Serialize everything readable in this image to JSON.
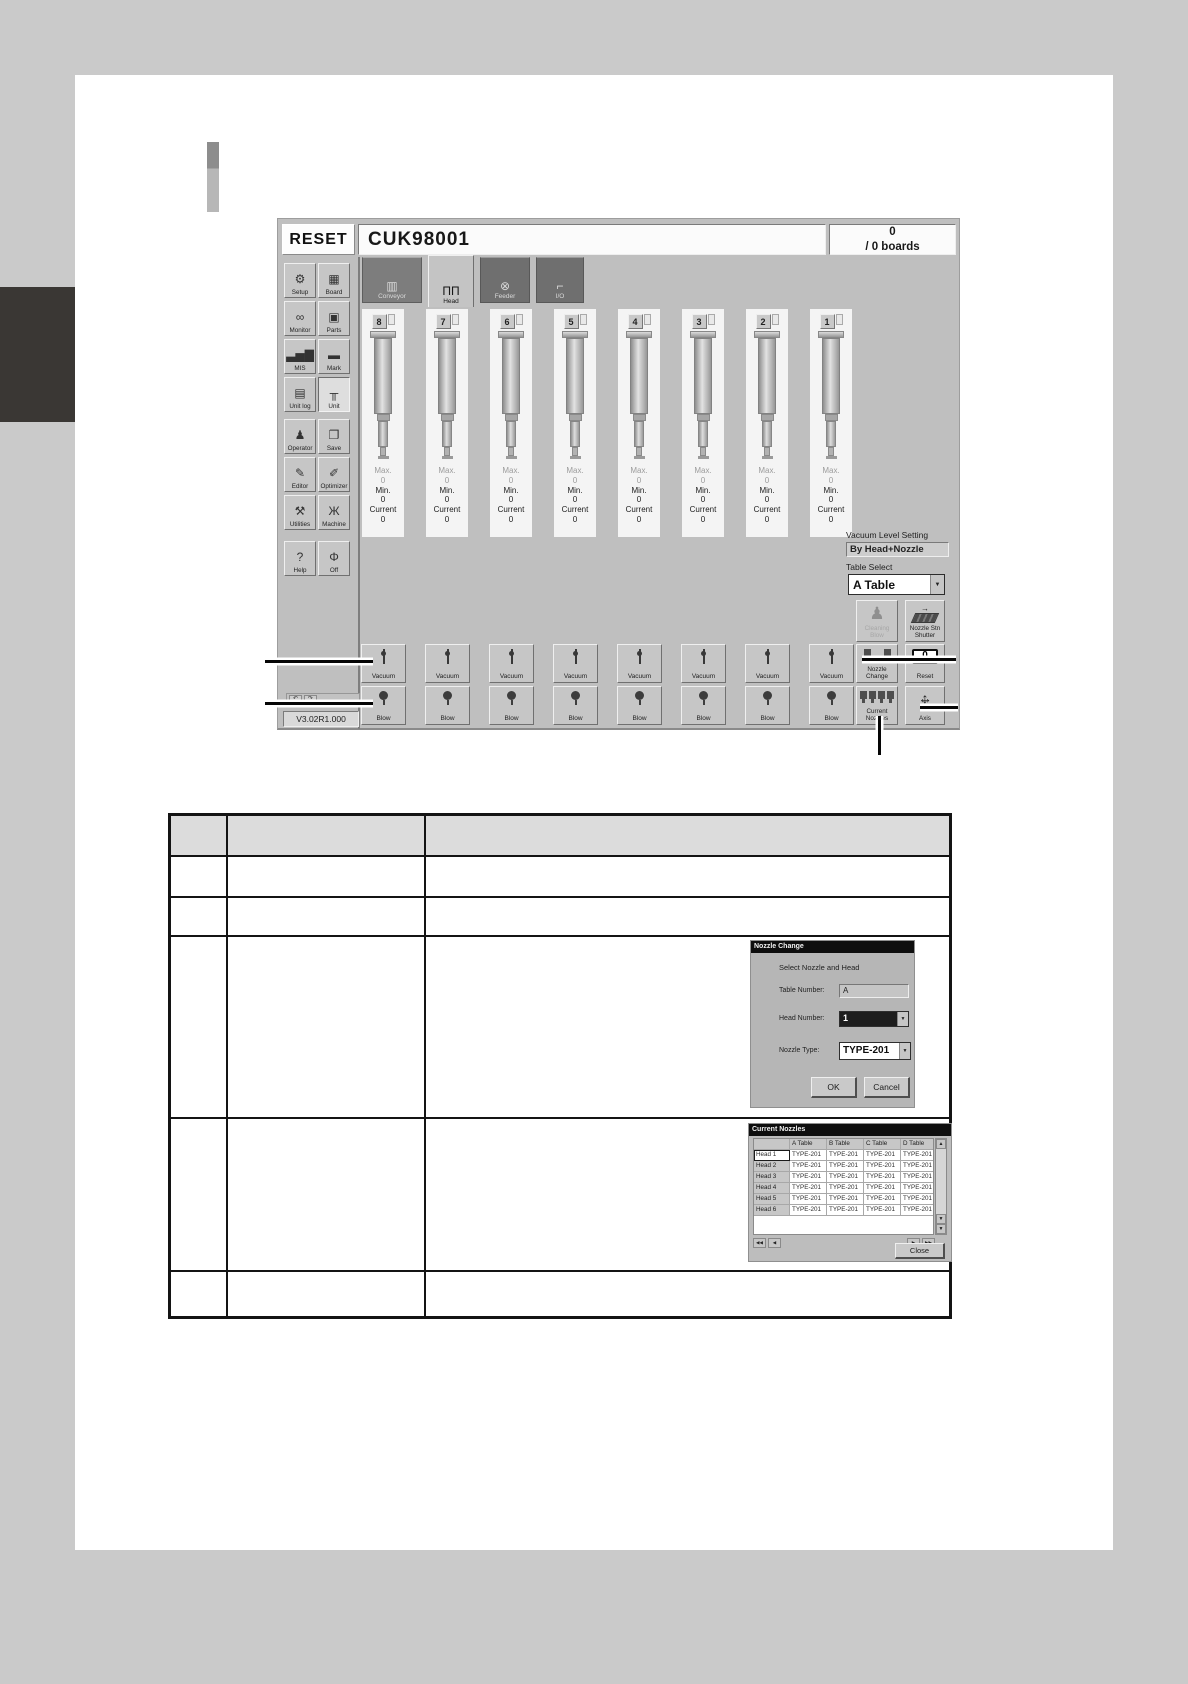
{
  "machine_ui": {
    "reset_button": "RESET",
    "title": "CUK98001",
    "boards": {
      "count": "0",
      "label": "/ 0 boards"
    },
    "sidebar": {
      "buttons": [
        {
          "label": "Setup",
          "icon": "setup-icon",
          "glyph": "⚙"
        },
        {
          "label": "Board",
          "icon": "board-icon",
          "glyph": "▦"
        },
        {
          "label": "Monitor",
          "icon": "monitor-icon",
          "glyph": "∞"
        },
        {
          "label": "Parts",
          "icon": "parts-icon",
          "glyph": "▣"
        },
        {
          "label": "MIS",
          "icon": "mis-icon",
          "glyph": "▃▅▇"
        },
        {
          "label": "Mark",
          "icon": "mark-icon",
          "glyph": "▬"
        },
        {
          "label": "Unit log",
          "icon": "unit-log-icon",
          "glyph": "▤"
        },
        {
          "label": "Unit",
          "icon": "unit-icon",
          "glyph": "╥",
          "active": true
        },
        {
          "label": "Operator",
          "icon": "operator-icon",
          "glyph": "♟"
        },
        {
          "label": "Save",
          "icon": "save-icon",
          "glyph": "❐"
        },
        {
          "label": "Editor",
          "icon": "editor-icon",
          "glyph": "✎"
        },
        {
          "label": "Optimizer",
          "icon": "optimizer-icon",
          "glyph": "✐"
        },
        {
          "label": "Utilities",
          "icon": "utilities-icon",
          "glyph": "⚒"
        },
        {
          "label": "Machine",
          "icon": "machine-icon",
          "glyph": "Ж"
        },
        {
          "label": "Help",
          "icon": "help-icon",
          "glyph": "?"
        },
        {
          "label": "Off",
          "icon": "off-icon",
          "glyph": "Φ"
        }
      ]
    },
    "tabs": [
      {
        "label": "Conveyor",
        "icon": "conveyor-icon",
        "glyph": "▥",
        "state": "pressed"
      },
      {
        "label": "Head",
        "icon": "head-icon",
        "glyph": "ΠΠ",
        "state": "active"
      },
      {
        "label": "Feeder",
        "icon": "feeder-icon",
        "glyph": "⊗",
        "state": "normal"
      },
      {
        "label": "I/O",
        "icon": "io-icon",
        "glyph": "⌐",
        "state": "normal"
      }
    ],
    "heads": {
      "numbers": [
        "8",
        "7",
        "6",
        "5",
        "4",
        "3",
        "2",
        "1"
      ],
      "max_label": "Max.",
      "min_label": "Min.",
      "current_label": "Current",
      "max_value": "0",
      "min_value": "0",
      "current_value": "0",
      "vacuum_label": "Vacuum",
      "blow_label": "Blow"
    },
    "right_panel": {
      "vacuum_level_setting_label": "Vacuum Level Setting",
      "vacuum_level_setting_value": "By Head+Nozzle",
      "table_select_label": "Table Select",
      "table_select_value": "A Table",
      "cleaning_blow_label": "Cleaning Blow",
      "nozzle_stn_shutter_label": "Nozzle Stn Shutter",
      "nozzle_change_label": "Nozzle Change",
      "reset_label": "Reset",
      "reset_icon_text": "0",
      "current_nozzles_label": "Current Nozzles",
      "axis_label": "Axis"
    },
    "version": "V3.02R1.000"
  },
  "nozzle_change_dialog": {
    "title": "Nozzle Change",
    "subtitle": "Select Nozzle and Head",
    "table_number_label": "Table Number:",
    "table_number_value": "A",
    "head_number_label": "Head Number:",
    "head_number_value": "1",
    "nozzle_type_label": "Nozzle Type:",
    "nozzle_type_value": "TYPE-201",
    "ok_label": "OK",
    "cancel_label": "Cancel"
  },
  "current_nozzles_window": {
    "title": "Current Nozzles",
    "columns": [
      "A Table",
      "B Table",
      "C Table",
      "D Table"
    ],
    "rows": [
      {
        "head": "Head 1",
        "values": [
          "TYPE-201",
          "TYPE-201",
          "TYPE-201",
          "TYPE-201"
        ]
      },
      {
        "head": "Head 2",
        "values": [
          "TYPE-201",
          "TYPE-201",
          "TYPE-201",
          "TYPE-201"
        ]
      },
      {
        "head": "Head 3",
        "values": [
          "TYPE-201",
          "TYPE-201",
          "TYPE-201",
          "TYPE-201"
        ]
      },
      {
        "head": "Head 4",
        "values": [
          "TYPE-201",
          "TYPE-201",
          "TYPE-201",
          "TYPE-201"
        ]
      },
      {
        "head": "Head 5",
        "values": [
          "TYPE-201",
          "TYPE-201",
          "TYPE-201",
          "TYPE-201"
        ]
      },
      {
        "head": "Head 6",
        "values": [
          "TYPE-201",
          "TYPE-201",
          "TYPE-201",
          "TYPE-201"
        ]
      }
    ],
    "close_label": "Close"
  },
  "colors": {
    "page_margin": "#cacaca",
    "ui_background": "#bfbfbf",
    "table_header_bg": "#dcdcdc",
    "dark": "#141414"
  }
}
